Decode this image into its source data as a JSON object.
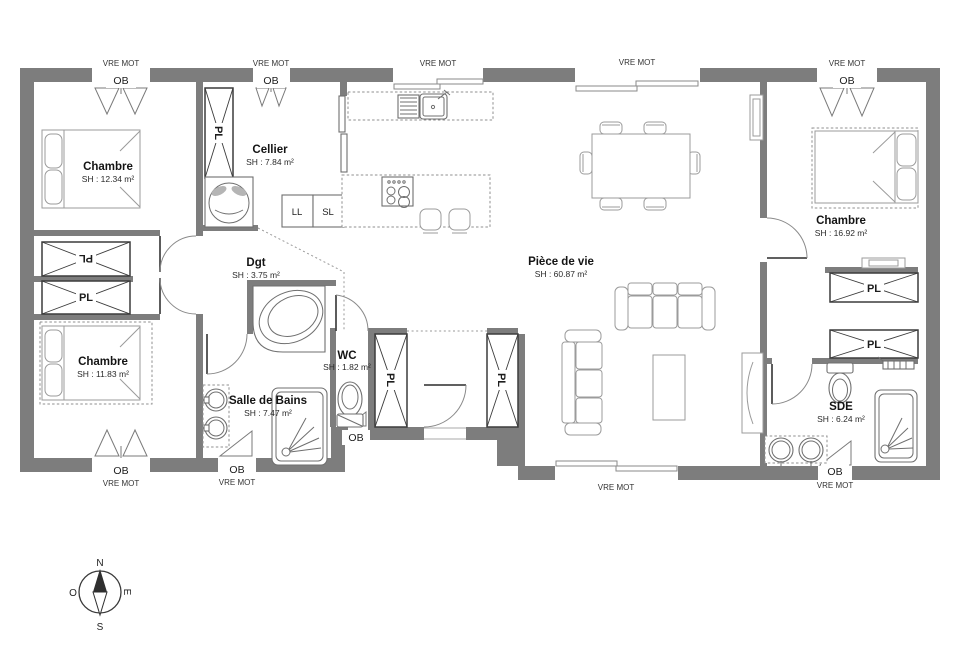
{
  "plan": {
    "rooms": [
      {
        "name": "Chambre",
        "area": "SH : 12.34 m²"
      },
      {
        "name": "Cellier",
        "area": "SH : 7.84 m²"
      },
      {
        "name": "Dgt",
        "area": "SH : 3.75 m²"
      },
      {
        "name": "Chambre",
        "area": "SH : 11.83 m²"
      },
      {
        "name": "Salle de Bains",
        "area": "SH : 7.47 m²"
      },
      {
        "name": "WC",
        "area": "SH : 1.82 m²"
      },
      {
        "name": "Pièce de vie",
        "area": "SH : 60.87 m²"
      },
      {
        "name": "Chambre",
        "area": "SH : 16.92 m²"
      },
      {
        "name": "SDE",
        "area": "SH : 6.24 m²"
      }
    ],
    "labels": {
      "closet": "PL",
      "window_roller": "VRE MOT",
      "window_ob": "OB",
      "washing_machine": "LL",
      "dryer": "SL"
    },
    "compass": {
      "n": "N",
      "s": "S",
      "e": "E",
      "o": "O"
    },
    "colors": {
      "wall": "#7d7d7d"
    }
  }
}
